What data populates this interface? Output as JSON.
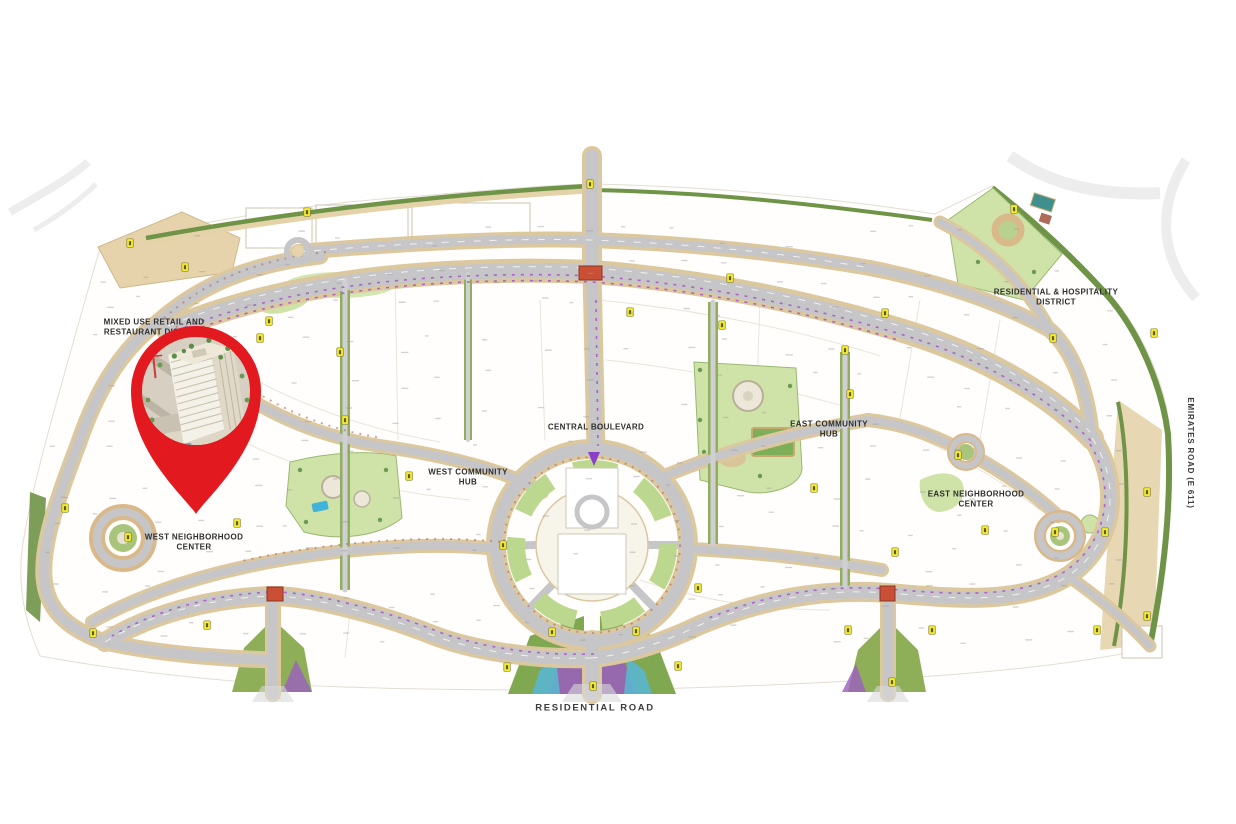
{
  "map": {
    "labels": {
      "mixed_use_line1": "MIXED USE RETAIL AND",
      "mixed_use_line2": "RESTAURANT DISTRICT",
      "central_boulevard": "CENTRAL BOULEVARD",
      "west_community_hub_line1": "WEST COMMUNITY",
      "west_community_hub_line2": "HUB",
      "east_community_hub_line1": "EAST COMMUNITY",
      "east_community_hub_line2": "HUB",
      "residential_hospitality_line1": "RESIDENTIAL & HOSPITALITY",
      "residential_hospitality_line2": "DISTRICT",
      "east_neighborhood_center_line1": "EAST NEIGHBORHOOD",
      "east_neighborhood_center_line2": "CENTER",
      "west_neighborhood_center_line1": "WEST NEIGHBORHOOD",
      "west_neighborhood_center_line2": "CENTER",
      "residential_road": "RESIDENTIAL ROAD",
      "emirates_road": "EMIRATES ROAD (E 611)"
    },
    "pin": {
      "icon": "location-pin-icon"
    },
    "colors": {
      "pin_red": "#e2191f",
      "road_gray": "#c6c6c8",
      "road_casing_tan": "#dcc89e",
      "green_edge": "#6f9447",
      "lawn_green": "#cfe3a8",
      "median_green": "#8fae5e",
      "parcel_tan": "#e6d3ab",
      "badge_yellow": "#f6ec2f",
      "intersection_red": "#c94f35",
      "pool_blue": "#3fb4d8",
      "planting_purple": "#a958c4"
    }
  }
}
